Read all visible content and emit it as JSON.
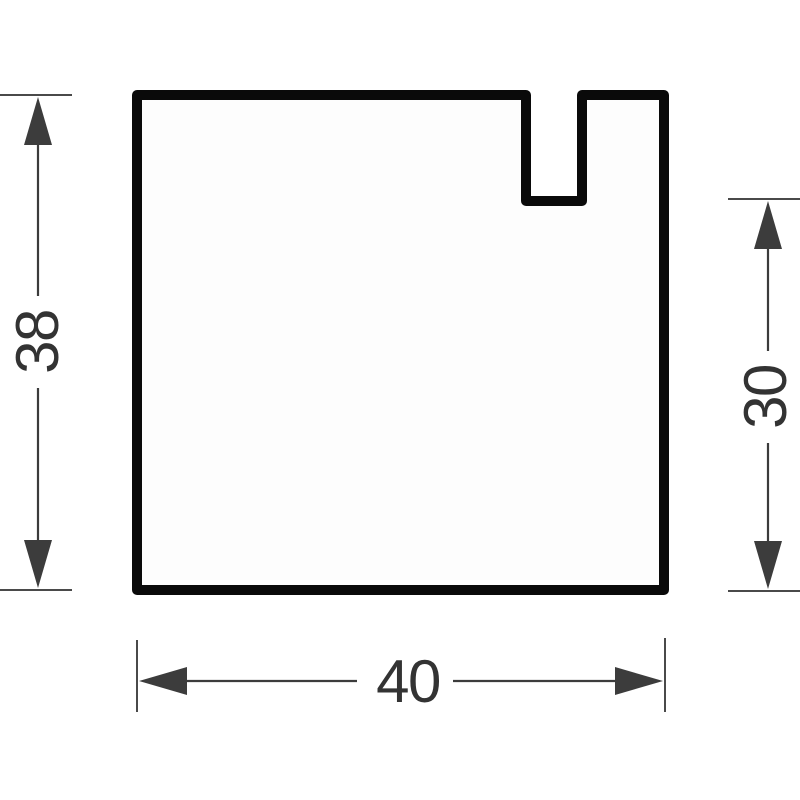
{
  "drawing": {
    "type": "technical-dimension-drawing",
    "part": {
      "shape": "square cross-section profile",
      "feature": "open rectangular slot on top edge, right of center"
    },
    "dimensions": {
      "overall_height": {
        "label": "38",
        "side": "left",
        "orientation": "vertical"
      },
      "slot_floor_height": {
        "label": "30",
        "side": "right",
        "orientation": "vertical"
      },
      "overall_width": {
        "label": "40",
        "side": "bottom",
        "orientation": "horizontal"
      }
    },
    "colors": {
      "outline": "#0a0a0a",
      "dimension": "#3c3c3c",
      "text": "#333333",
      "part_fill": "#fdfdfd",
      "background": "#ffffff"
    }
  }
}
